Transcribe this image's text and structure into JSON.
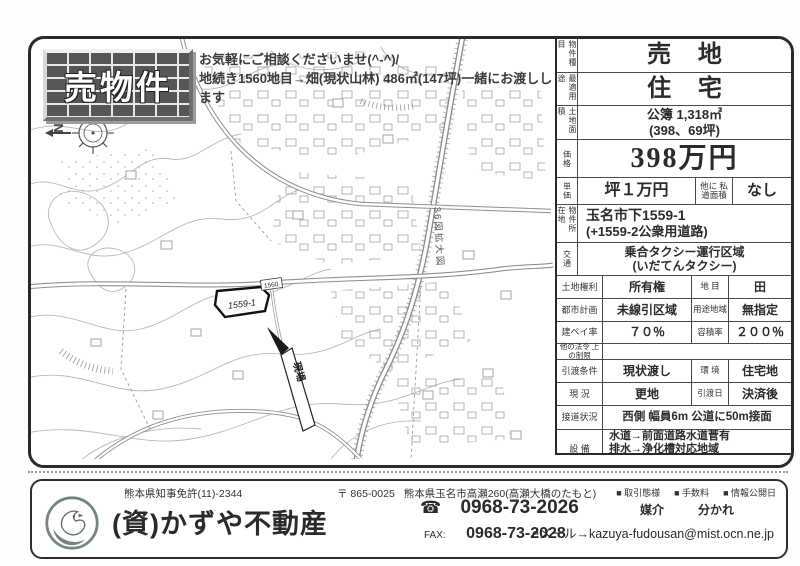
{
  "header": {
    "banner": "売物件",
    "note_line1": "お気軽にご相談くださいませ(^-^)/",
    "note_line2": "地続き1560地目→畑(現状山林) 486㎡(147坪)一緒にお渡しします"
  },
  "map": {
    "compass_label": "N",
    "parcel_label": "1559-1",
    "adjacent_parcel_label": "1560",
    "site_arrow_label": "現場",
    "road_label": "36図拡大図"
  },
  "details": {
    "property_type_label": "物件種目",
    "property_type": "売 地",
    "best_use_label": "最適用途",
    "best_use": "住 宅",
    "land_area_label": "土地面積",
    "land_area_line1": "公簿 1,318㎡",
    "land_area_line2": "(398、69坪)",
    "price_label": "価格",
    "price": "398万円",
    "unit_price_label": "単価",
    "unit_price": "坪１万円",
    "private_road_label": "他に 私道面積",
    "private_road": "なし",
    "location_label": "物件所在地",
    "location_line1": "玉名市下1559-1",
    "location_line2": "(+1559-2公衆用道路)",
    "transport_label": "交通",
    "transport_line1": "乗合タクシー運行区域",
    "transport_line2": "(いだてんタクシー)",
    "land_rights_label": "土地権利",
    "land_rights": "所有権",
    "land_category_label": "地 目",
    "land_category": "田",
    "city_planning_label": "都市計画",
    "city_planning": "未線引区域",
    "zoning_label": "用途地域",
    "zoning": "無指定",
    "coverage_label": "建ペイ率",
    "coverage": "７０％",
    "far_label": "容積率",
    "far": "２００％",
    "other_laws_label": "他の法令 上の制限",
    "other_laws": "",
    "handover_cond_label": "引渡条件",
    "handover_cond": "現状渡し",
    "environment_label": "環 境",
    "environment": "住宅地",
    "current_state_label": "現 況",
    "current_state": "更地",
    "handover_date_label": "引渡日",
    "handover_date": "決済後",
    "road_access_label": "接道状況",
    "road_access": "西側 幅員6m 公道に50m接面",
    "facilities_label": "設 備",
    "facilities_line1": "水道→前面道路水道菅有",
    "facilities_line2": "排水→浄化槽対応地域",
    "facilities_line3": "プロパンガス",
    "remarks_label": "備 考",
    "remarks": "農地転用必要です"
  },
  "footer": {
    "license": "熊本県知事免許(11)-2344",
    "postal": "〒 865-0025",
    "address": "熊本県玉名市高瀬260(高瀬大橋のたもと)",
    "legend_transaction": "■ 取引態様",
    "legend_fee": "■ 手数料",
    "legend_disclosure": "■ 情報公開日",
    "transaction_type": "媒介",
    "fee": "分かれ",
    "company": "(資)かずや不動産",
    "tel_icon": "☎",
    "tel": "0968-73-2026",
    "fax_label": "FAX:",
    "fax": "0968-73-2028",
    "email": "eメール→kazuya-fudousan@mist.ocn.ne.jp"
  },
  "colors": {
    "ink": "#2b2b2b",
    "map_line": "#b8b8b8",
    "logo_green": "#74867b"
  }
}
